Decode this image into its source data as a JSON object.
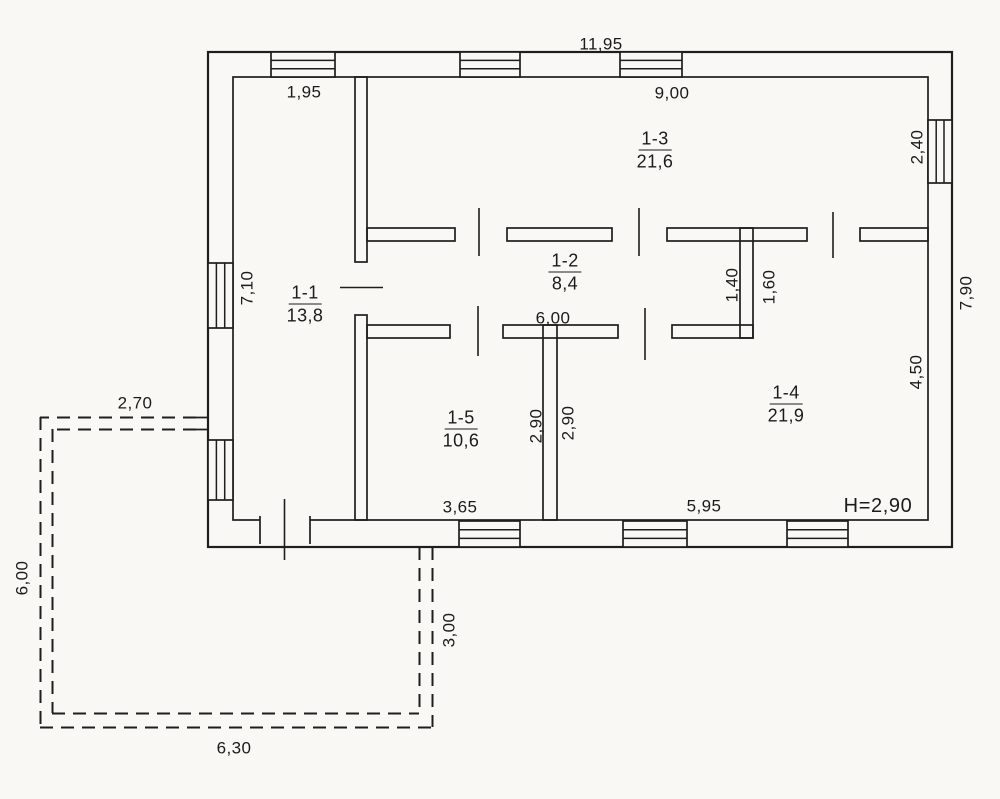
{
  "plan": {
    "type": "floor-plan",
    "background_color": "#f9f8f4",
    "line_color": "#1e1e1e",
    "units": "meters (comma decimal)"
  },
  "rooms": [
    {
      "id": "1-1",
      "area": "13,8"
    },
    {
      "id": "1-2",
      "area": "8,4"
    },
    {
      "id": "1-3",
      "area": "21,6"
    },
    {
      "id": "1-4",
      "area": "21,9"
    },
    {
      "id": "1-5",
      "area": "10,6"
    }
  ],
  "dims": {
    "total_width": "11,95",
    "total_height": "7,90",
    "room1_width": "1,95",
    "room1_height": "7,10",
    "room3_width": "9,00",
    "room3_window_height": "2,40",
    "room2_width": "6,00",
    "room2_end_width": "1,40",
    "room4_top_offset": "1,60",
    "room4_right_height": "4,50",
    "room4_width": "5,95",
    "room4_left_height": "2,90",
    "room5_width": "3,65",
    "room5_height": "2,90",
    "ceiling_height": "H=2,90",
    "porch_top_width": "2,70",
    "porch_left_height": "6,00",
    "porch_right_height": "3,00",
    "porch_bottom_width": "6,30"
  }
}
